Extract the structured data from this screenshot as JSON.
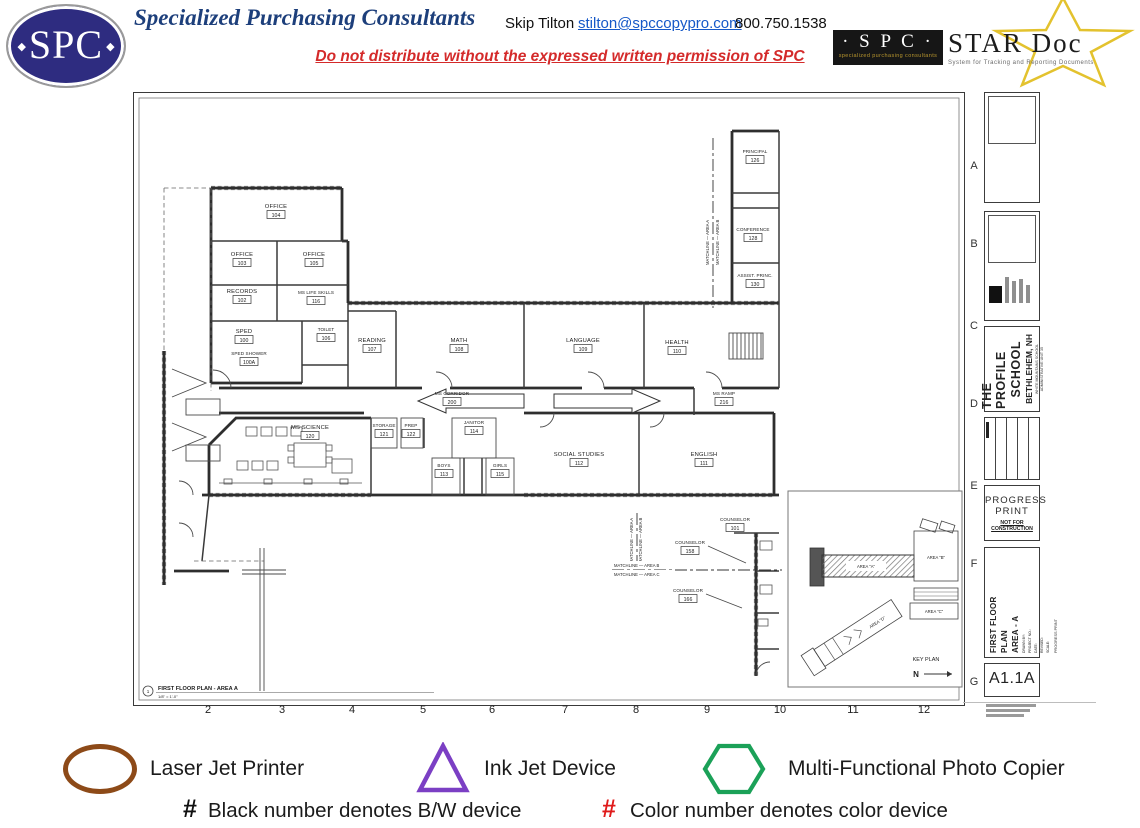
{
  "header": {
    "logo_text": "SPC",
    "company": "Specialized Purchasing Consultants",
    "contact_name": "Skip Tilton",
    "contact_email": "stilton@spccopypro.com",
    "contact_phone": "800.750.1538",
    "warning": "Do not distribute without the expressed written permission of SPC",
    "star_logo": {
      "spc": "· S P C ·",
      "spc_sub": "specialized purchasing consultants",
      "star": "STAR Doc",
      "star_sub": "System for Tracking and Reporting Documents",
      "star_color": "#e3c22e"
    }
  },
  "sheet": {
    "grid_letters": [
      "A",
      "B",
      "C",
      "D",
      "E",
      "F",
      "G"
    ],
    "ruler_numbers": [
      "2",
      "3",
      "4",
      "5",
      "6",
      "7",
      "8",
      "9",
      "10",
      "11",
      "12"
    ],
    "plan_callout": "1",
    "plan_title": "FIRST FLOOR PLAN - AREA A",
    "plan_scale": "1/8\" = 1'-0\"",
    "rooms": [
      {
        "name": "OFFICE",
        "number": "104"
      },
      {
        "name": "OFFICE",
        "number": "103"
      },
      {
        "name": "OFFICE",
        "number": "105"
      },
      {
        "name": "RECORDS",
        "number": "102"
      },
      {
        "name": "MS LIFE SKILLS",
        "number": "116"
      },
      {
        "name": "SPED",
        "number": "100"
      },
      {
        "name": "TOILET",
        "number": "106"
      },
      {
        "name": "SPED SHOWER",
        "number": "100A"
      },
      {
        "name": "READING",
        "number": "107"
      },
      {
        "name": "MATH",
        "number": "108"
      },
      {
        "name": "LANGUAGE",
        "number": "109"
      },
      {
        "name": "HEALTH",
        "number": "110"
      },
      {
        "name": "PRINCIPAL",
        "number": "126"
      },
      {
        "name": "CONFERENCE",
        "number": "128"
      },
      {
        "name": "ASSIST. PRINC.",
        "number": "130"
      },
      {
        "name": "MS CORRIDOR",
        "number": "200"
      },
      {
        "name": "MS RAMP",
        "number": "216"
      },
      {
        "name": "MS SCIENCE",
        "number": "120"
      },
      {
        "name": "STORAGE",
        "number": "121"
      },
      {
        "name": "PREP",
        "number": "122"
      },
      {
        "name": "JANITOR",
        "number": "114"
      },
      {
        "name": "BOYS",
        "number": "113"
      },
      {
        "name": "GIRLS",
        "number": "115"
      },
      {
        "name": "SOCIAL STUDIES",
        "number": "112"
      },
      {
        "name": "ENGLISH",
        "number": "111"
      },
      {
        "name": "COUNSELOR",
        "number": "101"
      },
      {
        "name": "COUNSELOR",
        "number": "158"
      },
      {
        "name": "COUNSELOR",
        "number": "166"
      }
    ],
    "matchlines": {
      "north_a": "MATCHLINE — AREA A",
      "north_b": "MATCHLINE — AREA B",
      "south_b": "MATCHLINE — AREA B",
      "south_c": "MATCHLINE — AREA C"
    },
    "key_plan": {
      "title": "KEY PLAN",
      "north": "N",
      "areas": [
        "AREA \"A\"",
        "AREA \"B\"",
        "AREA \"C\"",
        "AREA \"D\""
      ]
    }
  },
  "titleblock": {
    "school_name_1": "THE PROFILE",
    "school_name_2": "SCHOOL",
    "school_city": "BETHLEHEM, NH",
    "school_sub1": "WHITE MOUNTAINS SCHOOL",
    "school_sub2": "ADMINISTRATIVE UNIT 35",
    "progress1": "PROGRESS",
    "progress2": "PRINT",
    "not_for": "NOT FOR CONSTRUCTION",
    "sheet_title_1": "FIRST FLOOR",
    "sheet_title_2": "PLAN",
    "sheet_title_3": "AREA - A",
    "fields": [
      "DRAWN BY:",
      "PROJECT NO.:",
      "DATE:",
      "REVISED:",
      "SCALE:"
    ],
    "progress_note": "PROGRESS PRINT",
    "sheet_number": "A1.1A"
  },
  "legend": {
    "items": [
      {
        "label": "Laser Jet Printer",
        "shape": "oval",
        "color": "#8d4a18"
      },
      {
        "label": "Ink Jet Device",
        "shape": "triangle",
        "color": "#7b3fc4"
      },
      {
        "label": "Multi-Functional Photo Copier",
        "shape": "hexagon",
        "color": "#1ba158"
      }
    ],
    "bw_note": {
      "symbol": "#",
      "text": "Black number denotes B/W device",
      "color": "#111111"
    },
    "color_note": {
      "symbol": "#",
      "text": "Color number denotes color device",
      "color": "#e01b1b"
    }
  }
}
